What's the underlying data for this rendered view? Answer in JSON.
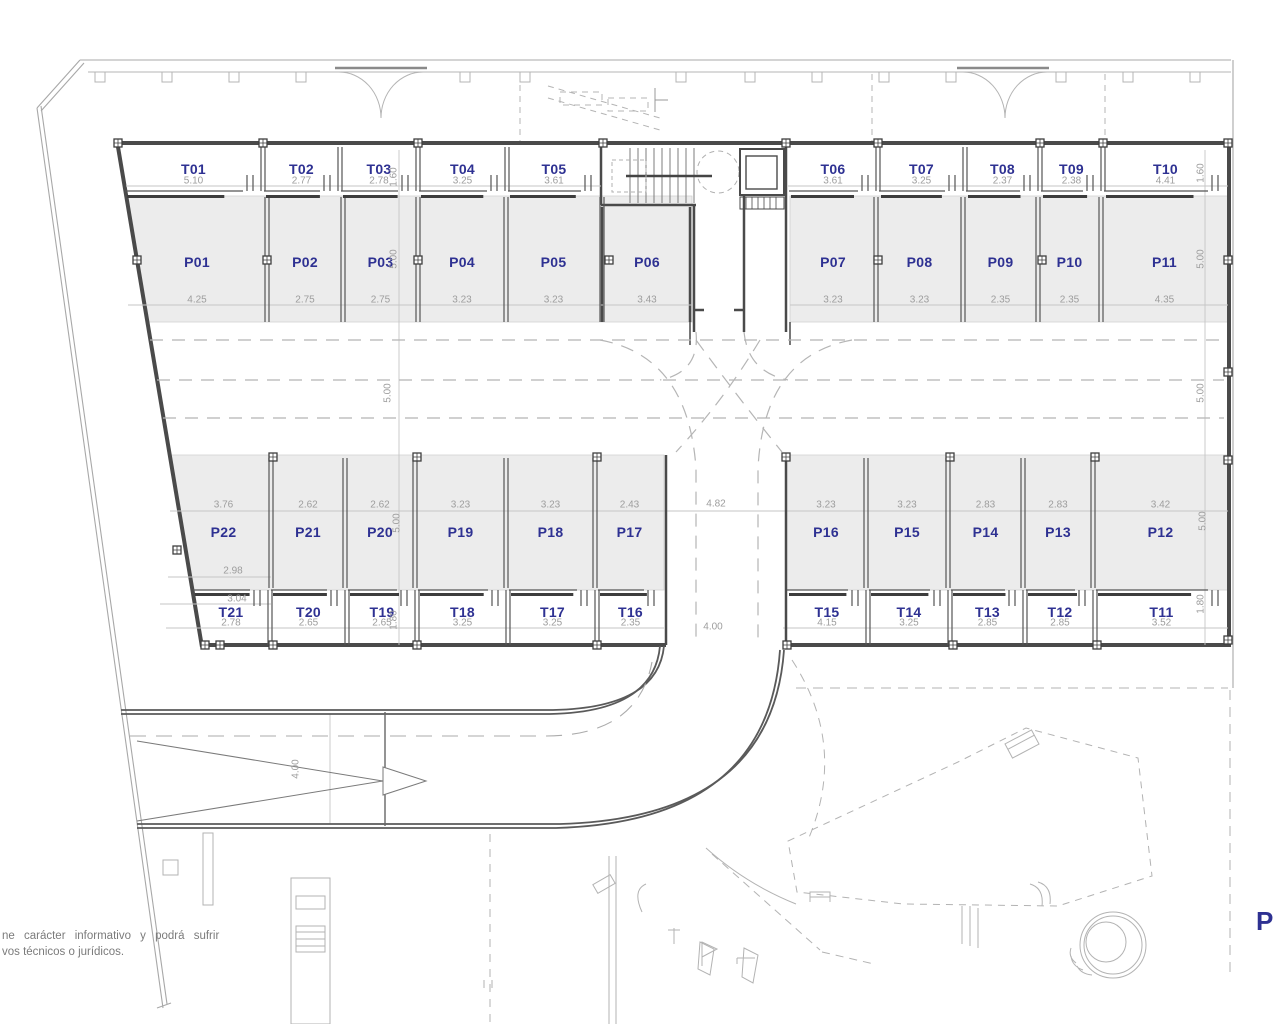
{
  "drawing": {
    "type": "basement-parking-floor-plan",
    "texts": {
      "disclaimer_line1": "ne carácter informativo y podrá sufrir",
      "disclaimer_line2": "vos técnicos o jurídicos.",
      "corner_label": "P"
    },
    "colors": {
      "accent_navy": "#2e3192",
      "dim_gray": "#9d9d9d",
      "stall_fill": "#ececec"
    },
    "units": {
      "storage_top_left": [
        {
          "id": "T01",
          "w": "5.10"
        },
        {
          "id": "T02",
          "w": "2.77"
        },
        {
          "id": "T03",
          "w": "2.78"
        },
        {
          "id": "T04",
          "w": "3.25"
        },
        {
          "id": "T05",
          "w": "3.61"
        }
      ],
      "storage_top_right": [
        {
          "id": "T06",
          "w": "3.61"
        },
        {
          "id": "T07",
          "w": "3.25"
        },
        {
          "id": "T08",
          "w": "2.37"
        },
        {
          "id": "T09",
          "w": "2.38"
        },
        {
          "id": "T10",
          "w": "4.41"
        }
      ],
      "parking_top_left": [
        {
          "id": "P01",
          "w": "4.25"
        },
        {
          "id": "P02",
          "w": "2.75"
        },
        {
          "id": "P03",
          "w": "2.75"
        },
        {
          "id": "P04",
          "w": "3.23"
        },
        {
          "id": "P05",
          "w": "3.23"
        },
        {
          "id": "P06",
          "w": "3.43"
        }
      ],
      "parking_top_right": [
        {
          "id": "P07",
          "w": "3.23"
        },
        {
          "id": "P08",
          "w": "3.23"
        },
        {
          "id": "P09",
          "w": "2.35"
        },
        {
          "id": "P10",
          "w": "2.35"
        },
        {
          "id": "P11",
          "w": "4.35"
        }
      ],
      "parking_bottom_left": [
        {
          "id": "P22",
          "w": "3.76"
        },
        {
          "id": "P21",
          "w": "2.62"
        },
        {
          "id": "P20",
          "w": "2.62"
        },
        {
          "id": "P19",
          "w": "3.23"
        },
        {
          "id": "P18",
          "w": "3.23"
        },
        {
          "id": "P17",
          "w": "2.43"
        }
      ],
      "parking_bottom_right": [
        {
          "id": "P16",
          "w": "3.23"
        },
        {
          "id": "P15",
          "w": "3.23"
        },
        {
          "id": "P14",
          "w": "2.83"
        },
        {
          "id": "P13",
          "w": "2.83"
        },
        {
          "id": "P12",
          "w": "3.42"
        }
      ],
      "storage_bottom_left": [
        {
          "id": "T21",
          "w": "2.78"
        },
        {
          "id": "T20",
          "w": "2.65"
        },
        {
          "id": "T19",
          "w": "2.65"
        },
        {
          "id": "T18",
          "w": "3.25"
        },
        {
          "id": "T17",
          "w": "3.25"
        },
        {
          "id": "T16",
          "w": "2.35"
        }
      ],
      "storage_bottom_right": [
        {
          "id": "T15",
          "w": "4.15"
        },
        {
          "id": "T14",
          "w": "3.25"
        },
        {
          "id": "T13",
          "w": "2.85"
        },
        {
          "id": "T12",
          "w": "2.85"
        },
        {
          "id": "T11",
          "w": "3.52"
        }
      ]
    },
    "row_dims": {
      "t_top": "1.60",
      "p_top": "5.00",
      "aisle": "5.00",
      "p_bottom": "5.00",
      "t_bottom": "1.80"
    },
    "misc_dims": {
      "junction_width": "4.82",
      "road_width": "4.00",
      "ramp_width": "4.00",
      "p22_inner": "2.98",
      "t21_outer": "3.04"
    }
  }
}
